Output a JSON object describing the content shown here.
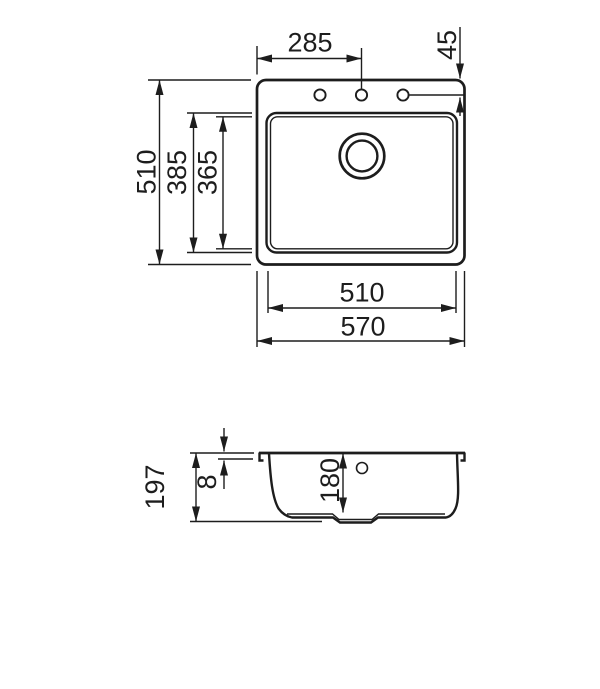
{
  "drawing": {
    "type": "technical-drawing",
    "subject": "kitchen sink — top view and cross-section with dimensions (mm)",
    "line_color": "#1d1d1d",
    "background": "#ffffff",
    "top_view": {
      "dimensions": {
        "tap_center_from_left": "285",
        "tap_center_from_back": "45",
        "overall_depth": "510",
        "bowl_outer_depth": "385",
        "bowl_inner_depth": "365",
        "bowl_width": "510",
        "overall_width": "570"
      }
    },
    "section_view": {
      "dimensions": {
        "total_height": "197",
        "rim_thickness": "8",
        "bowl_depth": "180"
      }
    }
  }
}
